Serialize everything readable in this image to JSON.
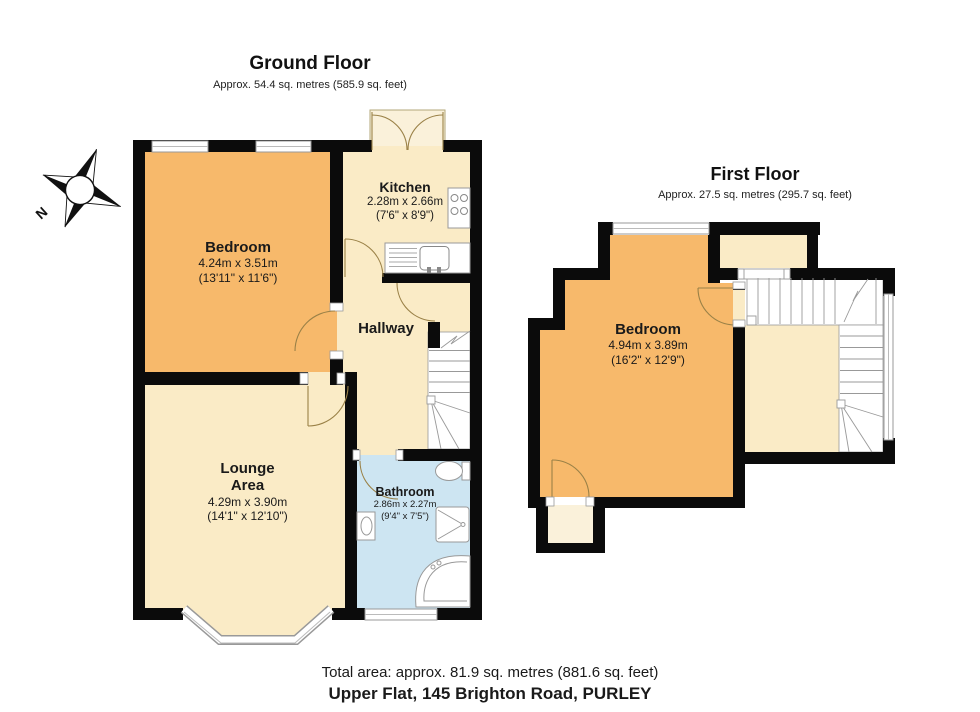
{
  "colors": {
    "wall": "#0b0b0b",
    "bedroom_orange": "#F7B96B",
    "cream": "#FAEBC6",
    "cream_light": "#FAF1DA",
    "bathroom_blue": "#CDE5F2",
    "door": "#9a8147",
    "fixture": "#999999"
  },
  "compass": {
    "north_label": "N"
  },
  "ground_floor": {
    "title": "Ground Floor",
    "subtitle": "Approx. 54.4 sq. metres (585.9 sq. feet)",
    "rooms": {
      "bedroom": {
        "name": "Bedroom",
        "dims_metric": "4.24m x 3.51m",
        "dims_imperial": "(13'11\" x 11'6\")"
      },
      "kitchen": {
        "name": "Kitchen",
        "dims_metric": "2.28m x 2.66m",
        "dims_imperial": "(7'6\" x 8'9\")"
      },
      "hallway": {
        "name": "Hallway"
      },
      "lounge": {
        "name": "Lounge Area",
        "dims_metric": "4.29m x 3.90m",
        "dims_imperial": "(14'1\" x 12'10\")"
      },
      "bathroom": {
        "name": "Bathroom",
        "dims_metric": "2.86m x 2.27m",
        "dims_imperial": "(9'4\" x 7'5\")"
      }
    }
  },
  "first_floor": {
    "title": "First Floor",
    "subtitle": "Approx. 27.5 sq. metres (295.7 sq. feet)",
    "rooms": {
      "bedroom": {
        "name": "Bedroom",
        "dims_metric": "4.94m x 3.89m",
        "dims_imperial": "(16'2\" x 12'9\")"
      }
    }
  },
  "footer": {
    "total_area": "Total area: approx. 81.9 sq. metres (881.6 sq. feet)",
    "address": "Upper Flat, 145 Brighton Road, PURLEY"
  }
}
